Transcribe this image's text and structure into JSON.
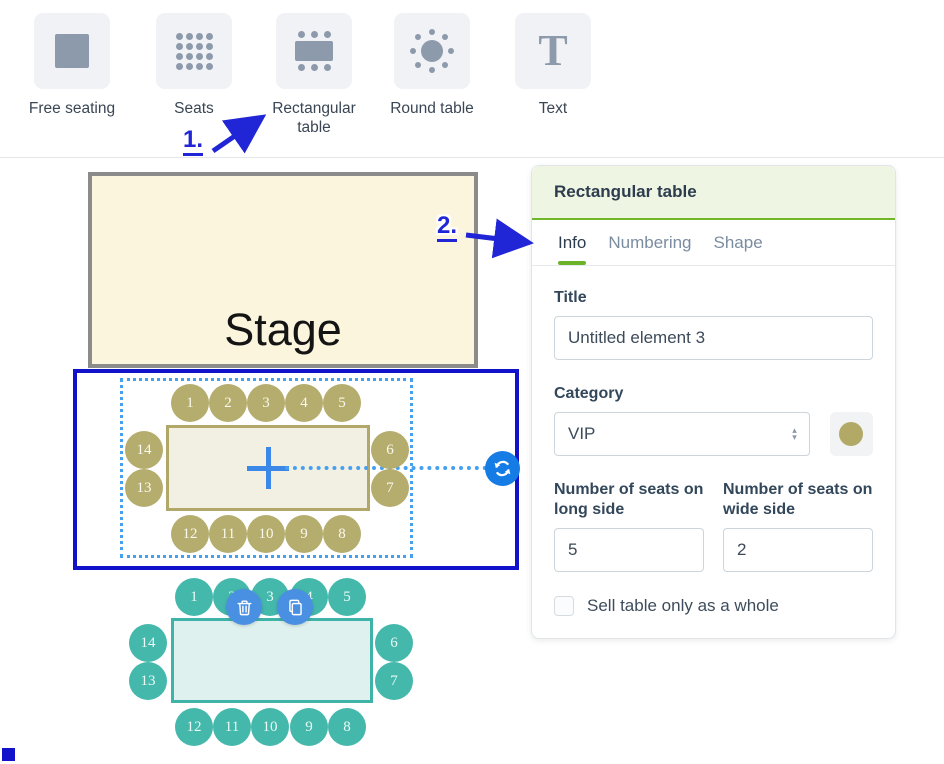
{
  "toolbar": {
    "tools": [
      {
        "label": "Free seating",
        "icon": "square-icon"
      },
      {
        "label": "Seats",
        "icon": "seat-grid-icon"
      },
      {
        "label": "Rectangular table",
        "icon": "rectangular-table-icon"
      },
      {
        "label": "Round table",
        "icon": "round-table-icon"
      },
      {
        "label": "Text",
        "icon": "text-icon"
      }
    ]
  },
  "annotations": {
    "step1": "1.",
    "step2": "2."
  },
  "canvas": {
    "stage_label": "Stage",
    "tables": [
      {
        "id": "selected-vip-table",
        "category_color": "#b5ad6e",
        "seats": {
          "top": [
            "1",
            "2",
            "3",
            "4",
            "5"
          ],
          "right": [
            "6",
            "7"
          ],
          "bottom": [
            "12",
            "11",
            "10",
            "9",
            "8"
          ],
          "left": [
            "14",
            "13"
          ]
        }
      },
      {
        "id": "teal-table",
        "category_color": "#45b8ac",
        "seats": {
          "top": [
            "1",
            "2",
            "3",
            "4",
            "5"
          ],
          "right": [
            "6",
            "7"
          ],
          "bottom": [
            "12",
            "11",
            "10",
            "9",
            "8"
          ],
          "left": [
            "14",
            "13"
          ]
        }
      }
    ],
    "icons": {
      "rotate": "rotate-icon",
      "trash": "trash-icon",
      "duplicate": "duplicate-icon",
      "center": "crosshair-icon"
    }
  },
  "panel": {
    "title": "Rectangular table",
    "tabs": [
      {
        "label": "Info",
        "active": true
      },
      {
        "label": "Numbering",
        "active": false
      },
      {
        "label": "Shape",
        "active": false
      }
    ],
    "fields": {
      "title_label": "Title",
      "title_value": "Untitled element 3",
      "category_label": "Category",
      "category_value": "VIP",
      "category_swatch_color": "#b2a966",
      "long_label": "Number of seats on long side",
      "long_value": "5",
      "wide_label": "Number of seats on wide side",
      "wide_value": "2",
      "sell_whole_label": "Sell table only as a whole",
      "sell_whole_checked": false
    }
  },
  "colors": {
    "selection_blue": "#1212cb",
    "guide_blue": "#46a0f2",
    "accent_green": "#70b628",
    "olive": "#b5ad6e",
    "teal": "#45b8ac",
    "action_blue": "#4a90e2",
    "annotation_blue": "#2026d6",
    "stage_fill": "#fcf5de"
  }
}
